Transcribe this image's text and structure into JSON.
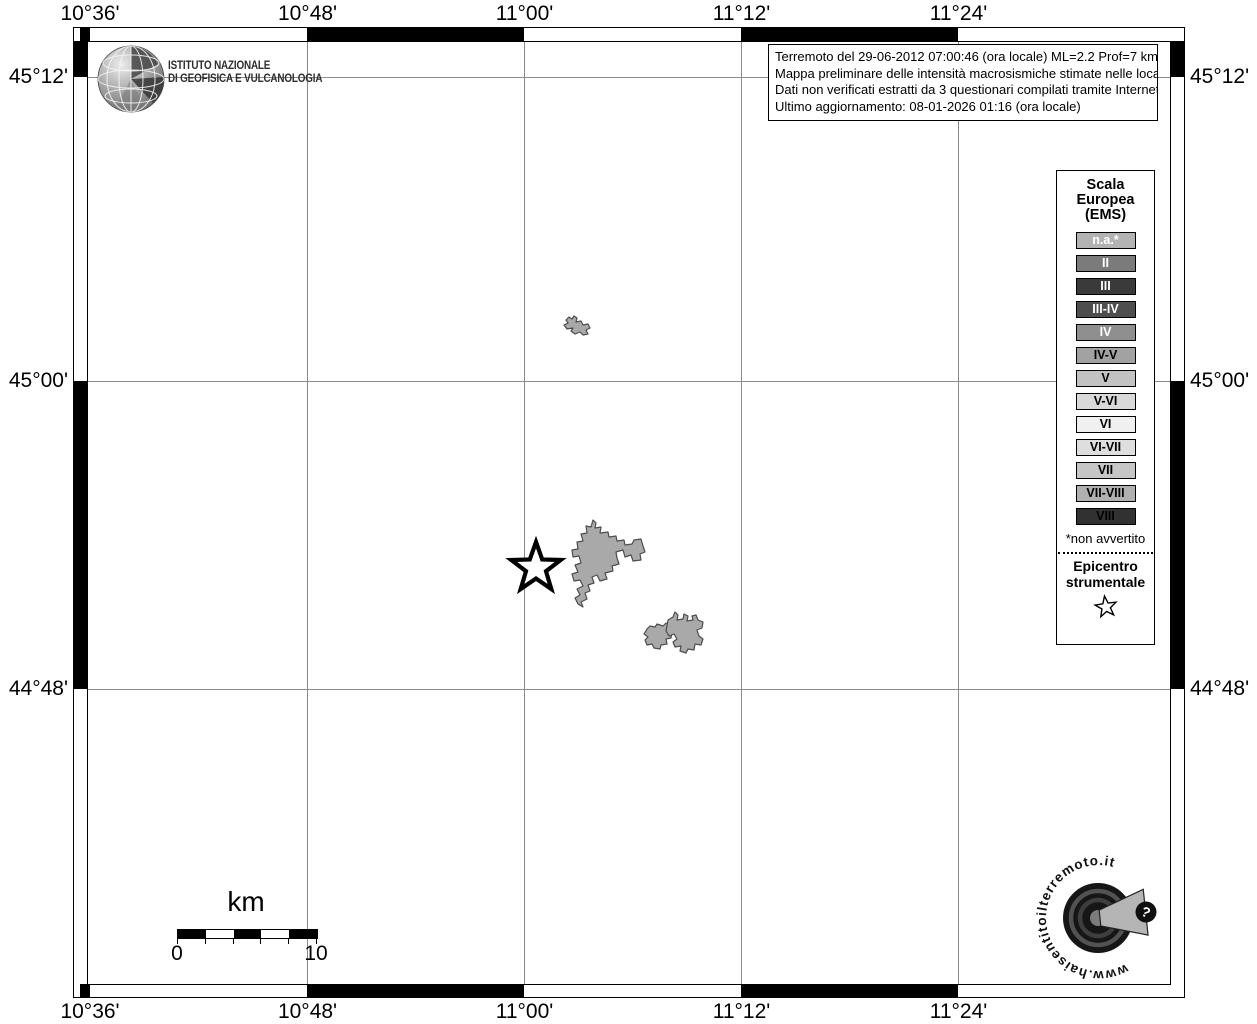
{
  "header": {
    "institute": {
      "line1": "ISTITUTO NAZIONALE",
      "line2": "DI GEOFISICA E VULCANOLOGIA"
    },
    "info_box": {
      "line1": "Terremoto del 29-06-2012 07:00:46 (ora locale) ML=2.2 Prof=7 km",
      "line2": "Mappa preliminare delle intensità macrosismiche stimate nelle località",
      "line3": "Dati non verificati estratti da 3 questionari compilati tramite Internet.",
      "line4": "Ultimo aggiornamento: 08-01-2026 01:16 (ora locale)"
    }
  },
  "axes": {
    "top": [
      "10°36'",
      "10°48'",
      "11°00'",
      "11°12'",
      "11°24'"
    ],
    "bottom": [
      "10°36'",
      "10°48'",
      "11°00'",
      "11°12'",
      "11°24'"
    ],
    "left": [
      "45°12'",
      "45°00'",
      "44°48'"
    ],
    "right": [
      "45°12'",
      "45°00'",
      "44°48'"
    ]
  },
  "legend": {
    "title": {
      "line1": "Scala",
      "line2": "Europea",
      "line3": "(EMS)"
    },
    "items": [
      {
        "label": "n.a.*",
        "bg": "#b3b3b3",
        "fg": "#ffffff"
      },
      {
        "label": "II",
        "bg": "#7b7b7b",
        "fg": "#ffffff"
      },
      {
        "label": "III",
        "bg": "#3a3a3a",
        "fg": "#ffffff"
      },
      {
        "label": "III-IV",
        "bg": "#4e4e4e",
        "fg": "#ffffff"
      },
      {
        "label": "IV",
        "bg": "#8f8f8f",
        "fg": "#ffffff"
      },
      {
        "label": "IV-V",
        "bg": "#a2a2a2",
        "fg": "#000000"
      },
      {
        "label": "V",
        "bg": "#c2c2c2",
        "fg": "#000000"
      },
      {
        "label": "V-VI",
        "bg": "#d9d9d9",
        "fg": "#000000"
      },
      {
        "label": "VI",
        "bg": "#f0f0f0",
        "fg": "#000000"
      },
      {
        "label": "VI-VII",
        "bg": "#dedede",
        "fg": "#000000"
      },
      {
        "label": "VII",
        "bg": "#c6c6c6",
        "fg": "#000000"
      },
      {
        "label": "VII-VIII",
        "bg": "#b0b0b0",
        "fg": "#000000"
      },
      {
        "label": "VIII",
        "bg": "#313131",
        "fg": "#000000"
      }
    ],
    "footnote": "*non avvertito",
    "epicenter": {
      "line1": "Epicentro",
      "line2": "strumentale"
    }
  },
  "scale_bar": {
    "unit": "km",
    "start": "0",
    "end": "10"
  },
  "site_logo": {
    "text": "www.haisentitoilterremoto.it",
    "badge": "?"
  }
}
